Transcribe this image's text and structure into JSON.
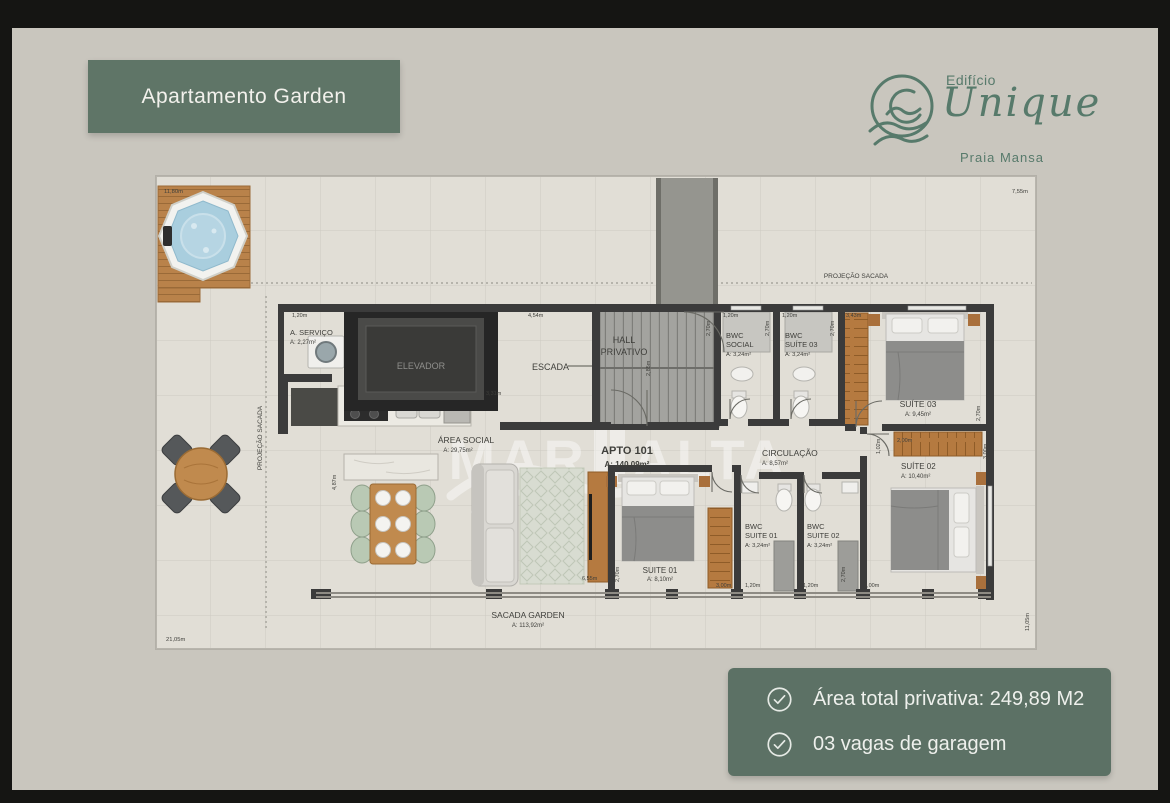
{
  "badge": {
    "label": "Apartamento Garden"
  },
  "logo": {
    "edificio": "Edifício",
    "name": "Unique",
    "place": "Praia Mansa"
  },
  "watermark": {
    "part1": "MAR",
    "part2": "ALTA",
    "sub": "IMÓVEIS"
  },
  "info_box": {
    "items": [
      {
        "label": "Área total privativa: 249,89 M2"
      },
      {
        "label": "03 vagas de garagem"
      }
    ]
  },
  "colors": {
    "accent_green": "#5f7567",
    "logo_green": "#577a6b",
    "wall": "#3b3b3b",
    "wood": "#b9824a",
    "water": "#abcdde"
  },
  "floorplan": {
    "labels": [
      {
        "t": "A. SERVIÇO",
        "x": 134,
        "y": 159,
        "s": 7.5,
        "n": "room-label-a-servico"
      },
      {
        "t": "A: 2,27m²",
        "x": 134,
        "y": 168,
        "s": 6,
        "n": "room-area-a-servico"
      },
      {
        "t": "ELEVADOR",
        "x": 265,
        "y": 193,
        "s": 9,
        "a": "middle",
        "c": "#8f8f8c",
        "n": "room-label-elevador"
      },
      {
        "t": "HALL",
        "x": 468,
        "y": 167,
        "s": 9,
        "a": "middle",
        "n": "room-label-hall"
      },
      {
        "t": "PRIVATIVO",
        "x": 468,
        "y": 179,
        "s": 9,
        "a": "middle",
        "n": "room-label-hall-2"
      },
      {
        "t": "ESCADA",
        "x": 376,
        "y": 194,
        "s": 9,
        "n": "room-label-escada"
      },
      {
        "t": "BWC",
        "x": 570,
        "y": 162,
        "s": 7.5,
        "n": "room-label-bwc-social"
      },
      {
        "t": "SOCIAL",
        "x": 570,
        "y": 171,
        "s": 7.5,
        "n": "room-label-bwc-social-2"
      },
      {
        "t": "A: 3,24m²",
        "x": 570,
        "y": 180,
        "s": 5.8,
        "n": "room-area-bwc-social"
      },
      {
        "t": "BWC",
        "x": 629,
        "y": 162,
        "s": 7.5,
        "n": "room-label-bwc-suite03"
      },
      {
        "t": "SUÍTE 03",
        "x": 629,
        "y": 171,
        "s": 7.5,
        "n": "room-label-bwc-suite03-2"
      },
      {
        "t": "A: 3,24m²",
        "x": 629,
        "y": 180,
        "s": 5.8,
        "n": "room-area-bwc-suite03"
      },
      {
        "t": "SUÍTE 03",
        "x": 762,
        "y": 231,
        "s": 8.5,
        "a": "middle",
        "n": "room-label-suite03"
      },
      {
        "t": "A: 9,45m²",
        "x": 762,
        "y": 240,
        "s": 6,
        "a": "middle",
        "n": "room-area-suite03"
      },
      {
        "t": "ÁREA SOCIAL",
        "x": 310,
        "y": 267,
        "s": 8.5,
        "a": "middle",
        "n": "room-label-area-social"
      },
      {
        "t": "A: 29,75m²",
        "x": 302,
        "y": 276,
        "s": 6,
        "a": "middle",
        "n": "room-area-area-social"
      },
      {
        "t": "APTO 101",
        "x": 471,
        "y": 278,
        "s": 11,
        "a": "middle",
        "w": "bold",
        "n": "apto-number-label"
      },
      {
        "t": "A: 140,09m²",
        "x": 471,
        "y": 291,
        "s": 8,
        "a": "middle",
        "w": "bold",
        "n": "apto-area-label"
      },
      {
        "t": "CIRCULAÇÃO",
        "x": 606,
        "y": 280,
        "s": 8.5,
        "n": "room-label-circulacao"
      },
      {
        "t": "A: 8,57m²",
        "x": 606,
        "y": 289,
        "s": 6,
        "n": "room-area-circulacao"
      },
      {
        "t": "SUITE 01",
        "x": 504,
        "y": 397,
        "s": 8,
        "a": "middle",
        "n": "room-label-suite01"
      },
      {
        "t": "A: 8,10m²",
        "x": 504,
        "y": 405,
        "s": 6,
        "a": "middle",
        "n": "room-area-suite01"
      },
      {
        "t": "BWC",
        "x": 589,
        "y": 353,
        "s": 7.5,
        "n": "room-label-bwc-suite01"
      },
      {
        "t": "SUITE 01",
        "x": 589,
        "y": 362,
        "s": 7.5,
        "n": "room-label-bwc-suite01-2"
      },
      {
        "t": "A: 3,24m²",
        "x": 589,
        "y": 371,
        "s": 5.8,
        "n": "room-area-bwc-suite01"
      },
      {
        "t": "BWC",
        "x": 651,
        "y": 353,
        "s": 7.5,
        "n": "room-label-bwc-suite02"
      },
      {
        "t": "SUITE 02",
        "x": 651,
        "y": 362,
        "s": 7.5,
        "n": "room-label-bwc-suite02-2"
      },
      {
        "t": "A: 3,24m²",
        "x": 651,
        "y": 371,
        "s": 5.8,
        "n": "room-area-bwc-suite02"
      },
      {
        "t": "SUÍTE 02",
        "x": 745,
        "y": 293,
        "s": 8,
        "n": "room-label-suite02"
      },
      {
        "t": "A: 10,40m²",
        "x": 745,
        "y": 302,
        "s": 6,
        "n": "room-area-suite02"
      },
      {
        "t": "SACADA GARDEN",
        "x": 372,
        "y": 442,
        "s": 8.5,
        "a": "middle",
        "n": "room-label-sacada-garden"
      },
      {
        "t": "A: 113,92m²",
        "x": 372,
        "y": 451,
        "s": 6,
        "a": "middle",
        "n": "room-area-sacada-garden"
      },
      {
        "t": "PROJEÇÃO SACADA",
        "x": 700,
        "y": 102,
        "s": 6.5,
        "a": "middle",
        "n": "projecao-sacada-top-label"
      },
      {
        "t": "PROJEÇÃO SACADA",
        "x": 106,
        "y": 262,
        "s": 6.5,
        "a": "middle",
        "r": -90,
        "n": "projecao-sacada-left-label"
      },
      {
        "t": "11,80m",
        "x": 8,
        "y": 17,
        "s": 5.8,
        "n": "dim-11-80"
      },
      {
        "t": "7,55m",
        "x": 872,
        "y": 17,
        "s": 5.8,
        "a": "end",
        "n": "dim-7-55"
      },
      {
        "t": "21,05m",
        "x": 10,
        "y": 465,
        "s": 5.8,
        "n": "dim-21-05"
      },
      {
        "t": "1,20m",
        "x": 136,
        "y": 141,
        "s": 5.5,
        "n": "dim-1-20-a"
      },
      {
        "t": "4,54m",
        "x": 372,
        "y": 141,
        "s": 5.5,
        "n": "dim-4-54"
      },
      {
        "t": "2,85m",
        "x": 494,
        "y": 200,
        "s": 5.5,
        "r": -90,
        "n": "dim-2-85"
      },
      {
        "t": "2,70m",
        "x": 554,
        "y": 160,
        "s": 5.5,
        "r": -90,
        "n": "dim-2-70-a"
      },
      {
        "t": "1,20m",
        "x": 567,
        "y": 141,
        "s": 5.5,
        "n": "dim-1-20-b"
      },
      {
        "t": "2,70m",
        "x": 613,
        "y": 160,
        "s": 5.5,
        "r": -90,
        "n": "dim-2-70-b"
      },
      {
        "t": "1,20m",
        "x": 626,
        "y": 141,
        "s": 5.5,
        "n": "dim-1-20-c"
      },
      {
        "t": "2,70m",
        "x": 678,
        "y": 160,
        "s": 5.5,
        "r": -90,
        "n": "dim-2-70-c"
      },
      {
        "t": "3,43m",
        "x": 690,
        "y": 141,
        "s": 5.5,
        "n": "dim-3-43"
      },
      {
        "t": "3,31m",
        "x": 330,
        "y": 219,
        "s": 5.5,
        "n": "dim-3-31"
      },
      {
        "t": "2,00m",
        "x": 741,
        "y": 266,
        "s": 5.5,
        "n": "dim-2-00"
      },
      {
        "t": "1,02m",
        "x": 724,
        "y": 278,
        "s": 5.5,
        "r": -90,
        "n": "dim-1-02"
      },
      {
        "t": "3,00m",
        "x": 831,
        "y": 283,
        "s": 5.5,
        "r": -90,
        "n": "dim-3-00-a"
      },
      {
        "t": "4,87m",
        "x": 180,
        "y": 314,
        "s": 5.5,
        "r": -90,
        "n": "dim-4-87"
      },
      {
        "t": "6,55m",
        "x": 426,
        "y": 404,
        "s": 5.5,
        "n": "dim-6-55"
      },
      {
        "t": "2,70m",
        "x": 463,
        "y": 406,
        "s": 5.5,
        "r": -90,
        "n": "dim-2-70-d"
      },
      {
        "t": "3,00m",
        "x": 560,
        "y": 411,
        "s": 5.5,
        "n": "dim-3-00-b"
      },
      {
        "t": "1,20m",
        "x": 589,
        "y": 411,
        "s": 5.5,
        "n": "dim-1-20-d"
      },
      {
        "t": "1,20m",
        "x": 647,
        "y": 411,
        "s": 5.5,
        "n": "dim-1-20-e"
      },
      {
        "t": "2,70m",
        "x": 689,
        "y": 406,
        "s": 5.5,
        "r": -90,
        "n": "dim-2-70-e"
      },
      {
        "t": "3,00m",
        "x": 708,
        "y": 411,
        "s": 5.5,
        "n": "dim-3-00-c"
      },
      {
        "t": "2,70m",
        "x": 824,
        "y": 245,
        "s": 5.5,
        "r": -90,
        "n": "dim-2-70-f"
      },
      {
        "t": "11,05m",
        "x": 873,
        "y": 455,
        "s": 5.5,
        "r": -90,
        "n": "dim-11-05"
      }
    ]
  }
}
